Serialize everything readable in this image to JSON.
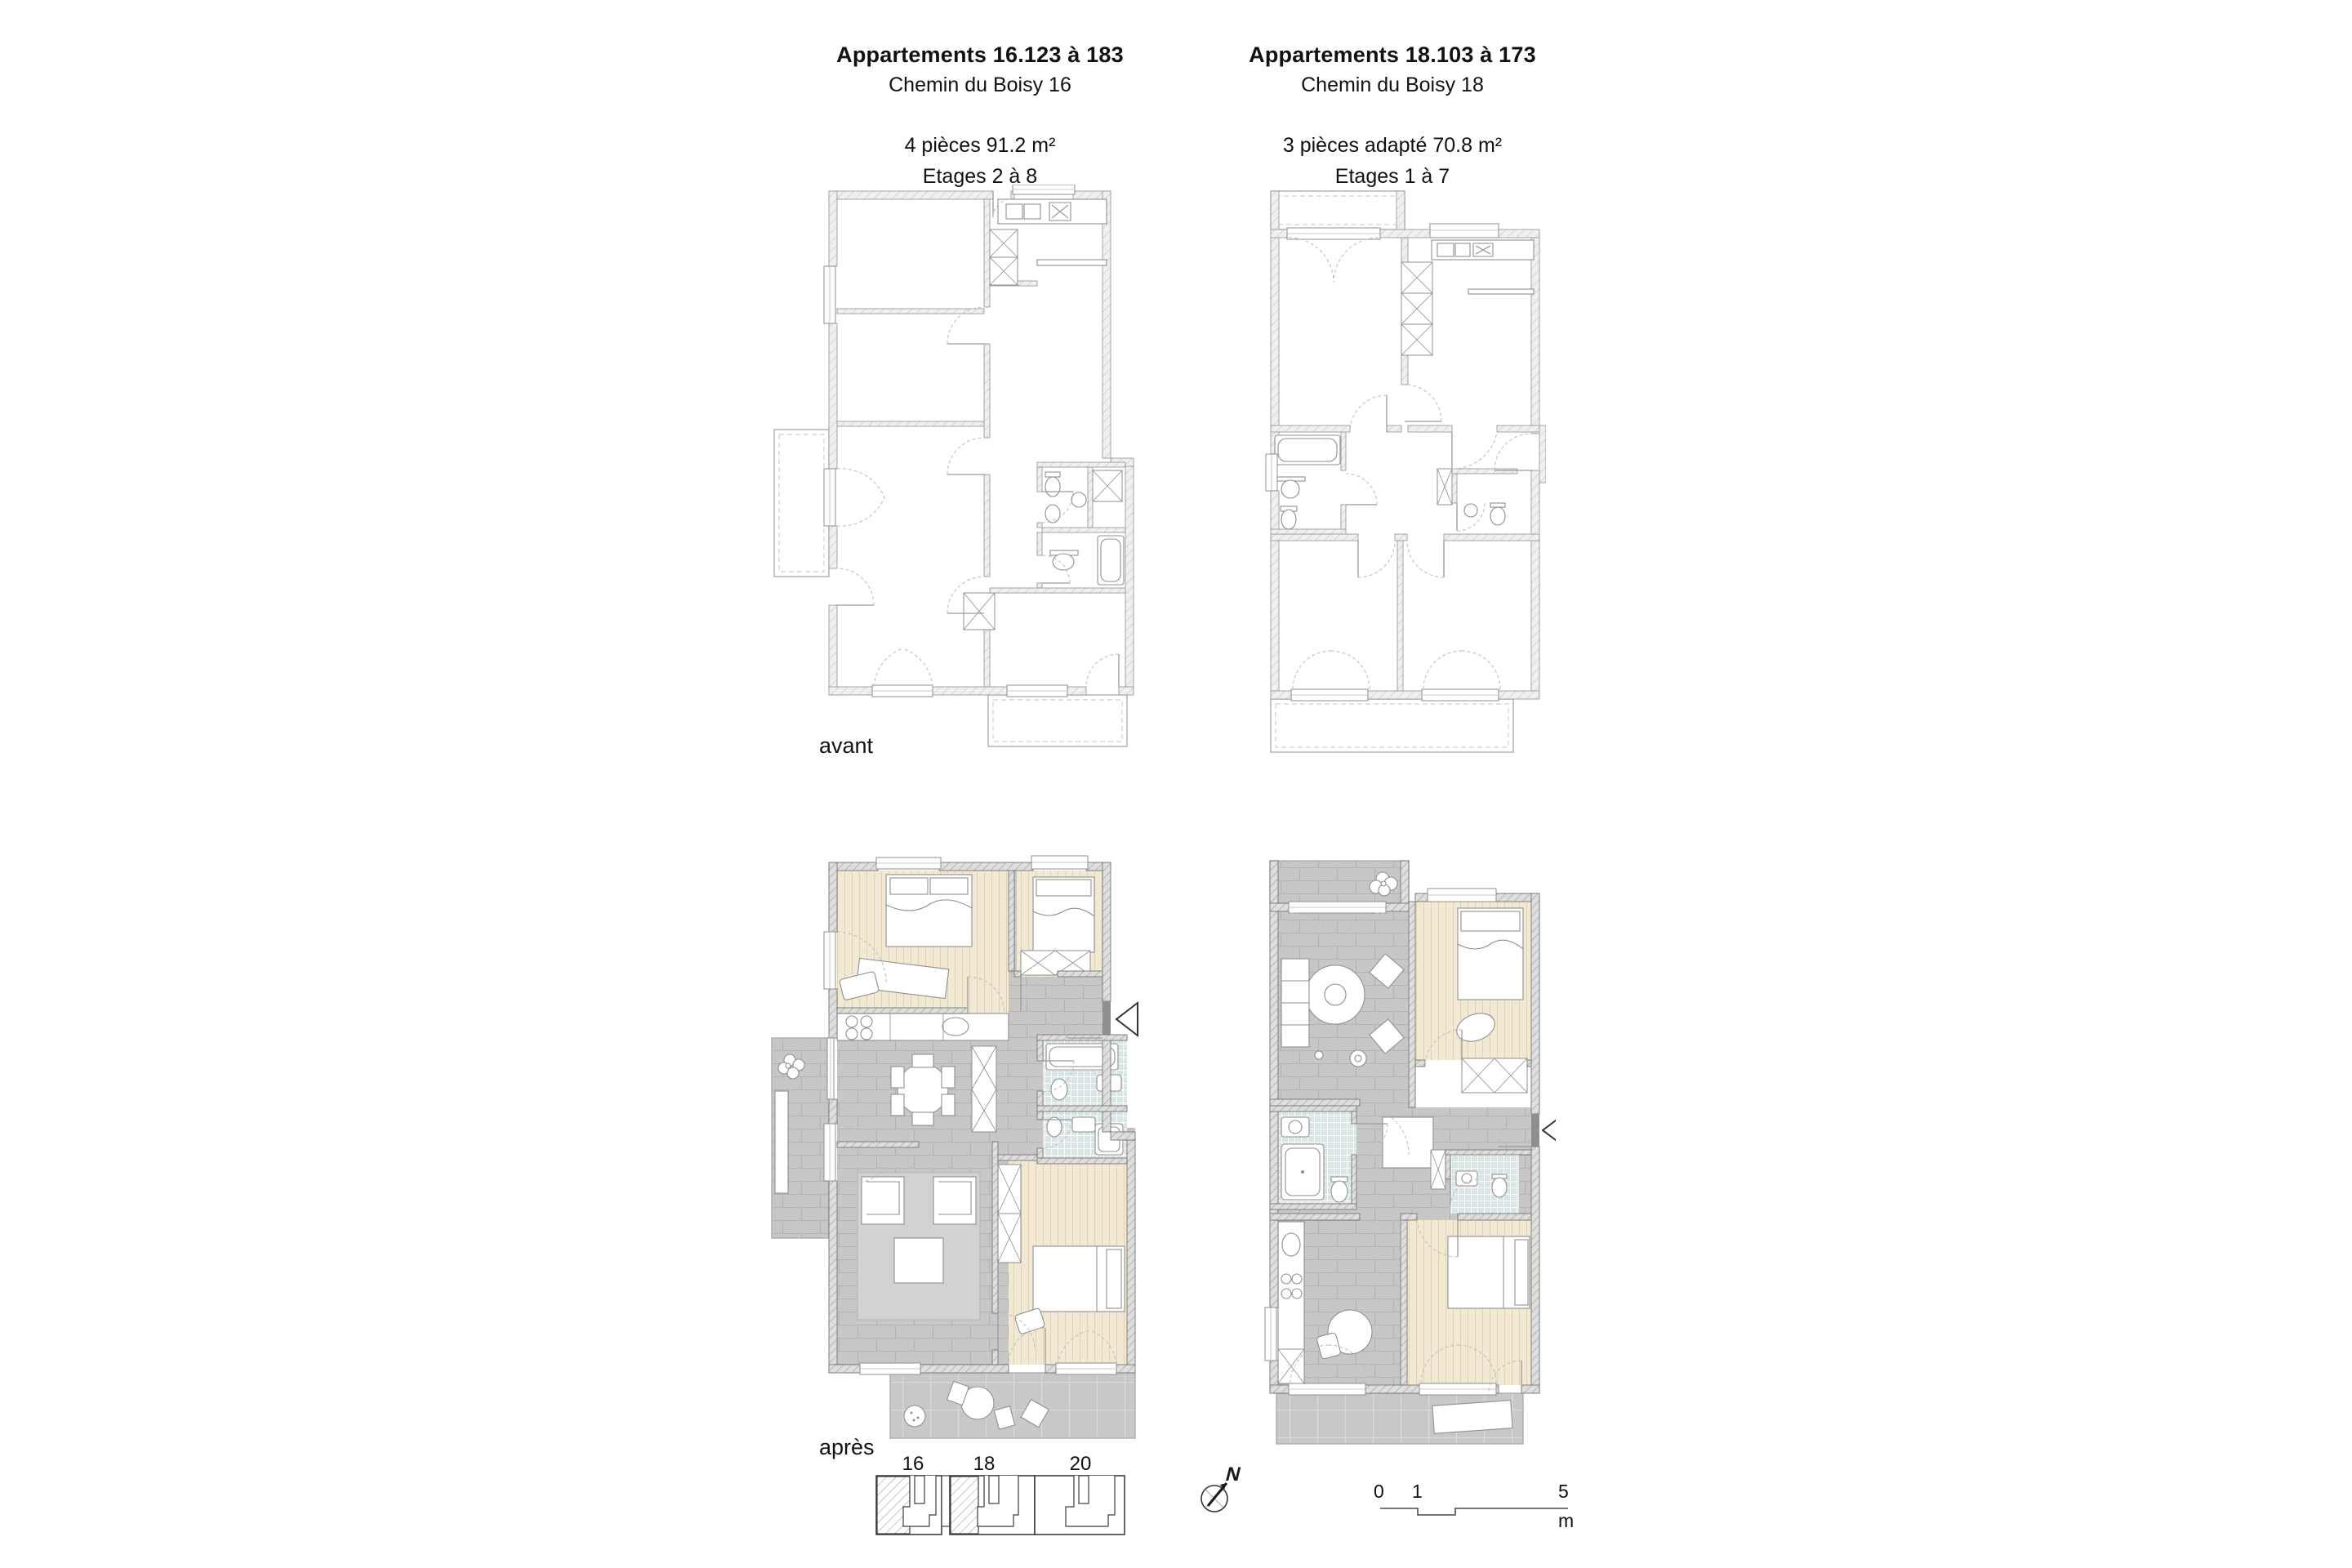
{
  "columns": [
    {
      "title": "Appartements 16.123 à 183",
      "address": "Chemin du Boisy 16",
      "spec": "4 pièces 91.2 m²",
      "floors": "Etages 2 à 8"
    },
    {
      "title": "Appartements 18.103 à 173",
      "address": "Chemin du Boisy 18",
      "spec": "3 pièces adapté 70.8 m²",
      "floors": "Etages 1 à 7"
    }
  ],
  "phase_labels": {
    "before": "avant",
    "after": "après"
  },
  "key_plan": {
    "labels": [
      "16",
      "18",
      "20"
    ]
  },
  "north_arrow": {
    "label": "N"
  },
  "scale_bar": {
    "tick0": "0",
    "tick1": "1",
    "tick5": "5",
    "unit": "m"
  },
  "colors": {
    "wall_hatch_avant": "#c9c9c9",
    "wall_hatch_apres": "#a3a3a3",
    "floor_tile_gray": "#c8c7c5",
    "floor_parquet": "#f2e9d4",
    "floor_bath_blue": "#d9e6e5",
    "line_gray": "#8f8f8f",
    "text": "#111111"
  }
}
